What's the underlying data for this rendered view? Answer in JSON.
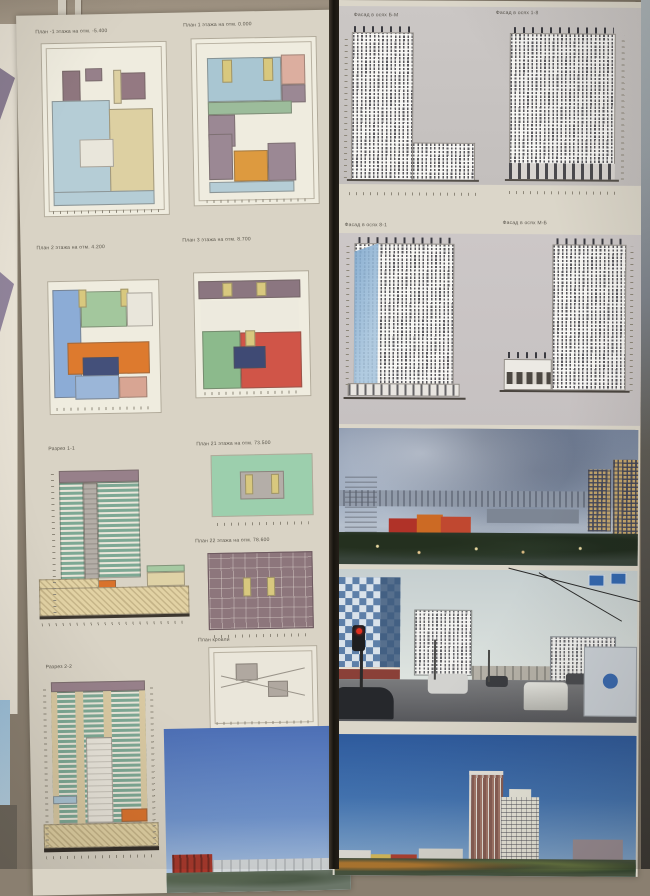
{
  "left_board": {
    "plans": [
      {
        "caption": "План -1 этажа на отм. -5.400"
      },
      {
        "caption": "План 1 этажа на отм. 0.000"
      },
      {
        "caption": "План 2 этажа на отм. 4.200"
      },
      {
        "caption": "План 3 этажа на отм. 8.700"
      },
      {
        "caption": "План 21 этажа на отм. 73.500"
      },
      {
        "caption": "План 22 этажа на отм. 78.600"
      }
    ],
    "roof_plan_caption": "План кровли",
    "sections": [
      {
        "caption": "Разрез 1-1"
      },
      {
        "caption": "Разрез 2-2"
      }
    ]
  },
  "right_board": {
    "facades": [
      {
        "caption": "Фасад в осях Б-М"
      },
      {
        "caption": "Фасад в осях 1-8"
      },
      {
        "caption": "Фасад в осях 8-1"
      },
      {
        "caption": "Фасад в осях М-Б"
      }
    ]
  },
  "palette": {
    "wall": "#8a7f70",
    "board_paper": "#d9d3c5",
    "facade_band": "#c8c3c1",
    "plan_blue": "#9db8d8",
    "plan_green": "#9cc49c",
    "plan_orange": "#dd7a2e",
    "plan_red": "#d05548",
    "plan_mauve": "#8e767e",
    "plan_tan": "#ddd0a2",
    "section_green": "#7da894",
    "glass_blue": "#7fa8ce",
    "render_sky": "#2e5a9c"
  }
}
